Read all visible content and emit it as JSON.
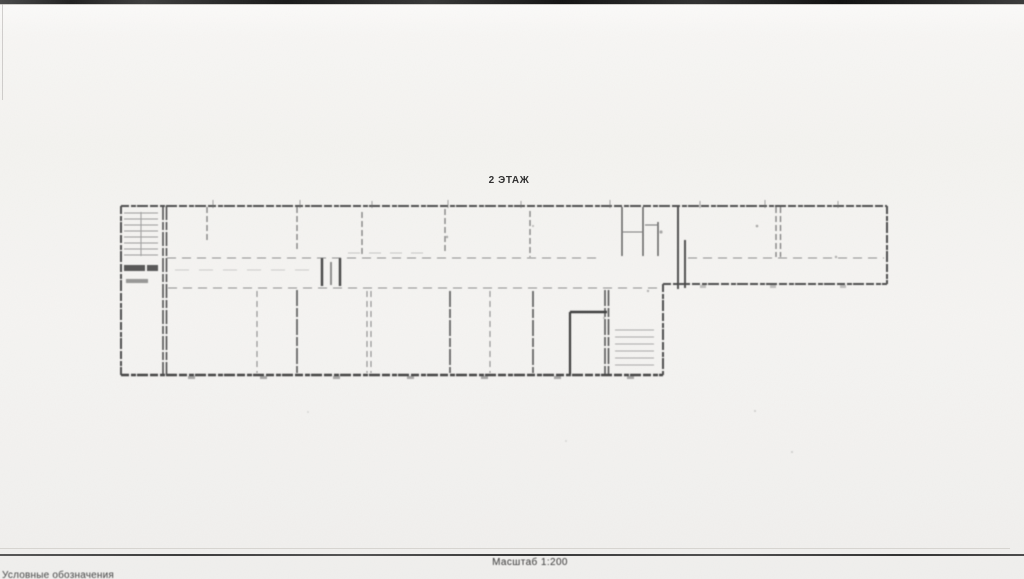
{
  "document": {
    "title": "2 ЭТАЖ",
    "scale_label": "Масштаб 1:200",
    "legend_label": "Условные обозначения"
  },
  "colors": {
    "paper": "#f4f3f0",
    "ink": "#2f2f2f",
    "wall_strong": "#4f4f4f",
    "wall_faint": "#8d8d8d",
    "top_border": "#1f1f1f",
    "footer_rule": "#4c4c4c"
  }
}
